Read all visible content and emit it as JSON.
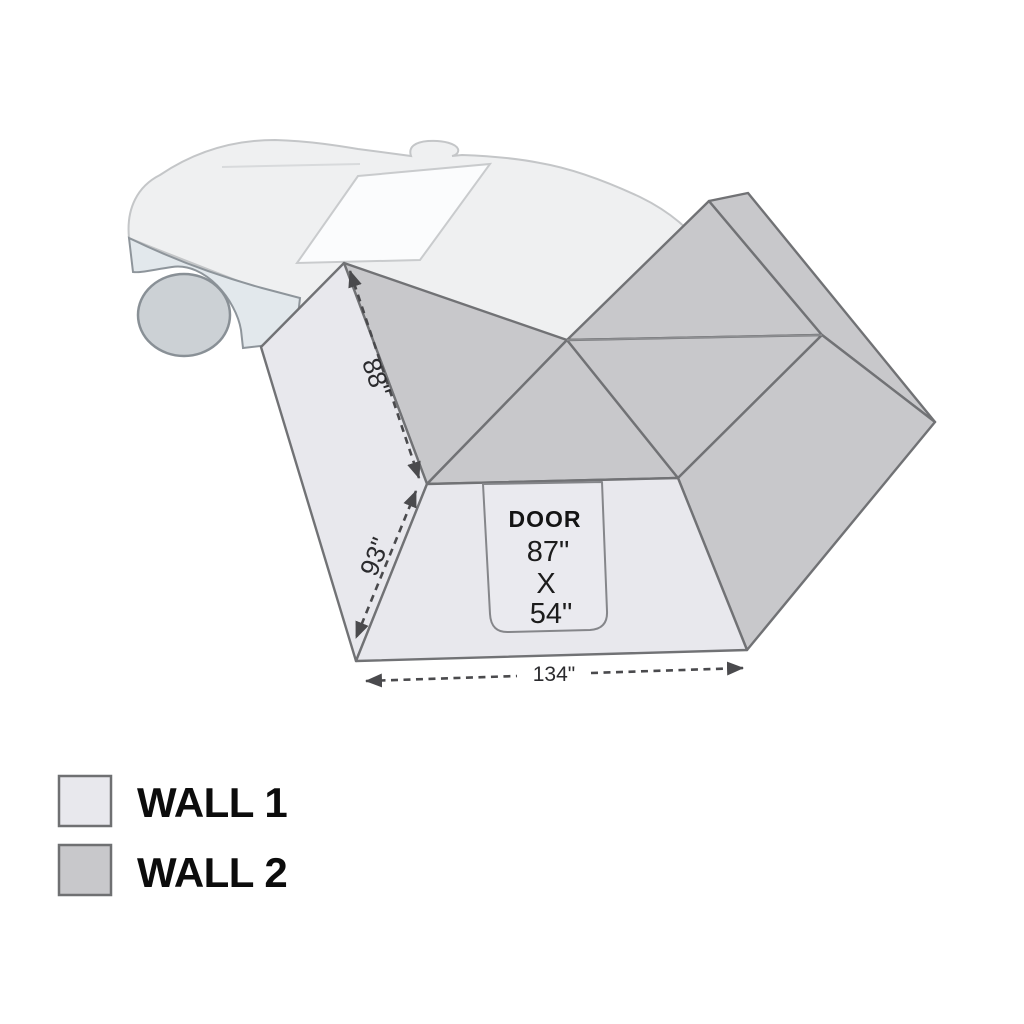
{
  "colors": {
    "wall1": "#e8e8ed",
    "wall2": "#c8c8cb",
    "door_fill": "#eaeaef",
    "structure_outline": "#717275",
    "thin_fold": "#8e8f92",
    "dimension": "#4a4a4d",
    "car_body": "#eff0f1",
    "car_body_outline": "#c4c6c8",
    "car_rear_panel": "#e2e8ec",
    "car_rear_panel_outline": "#8e959b",
    "car_wheel": "#ccd1d5",
    "car_wheel_outline": "#899096",
    "car_window": "#fbfcfd"
  },
  "dimensions": {
    "roof_edge": "88\"",
    "side_edge": "93\"",
    "base": "134\""
  },
  "door": {
    "label": "DOOR",
    "line1": "87\"",
    "line2": "X",
    "line3": "54\""
  },
  "legend": [
    {
      "label": "WALL 1",
      "color": "#e8e8ed"
    },
    {
      "label": "WALL 2",
      "color": "#c8c8cb"
    }
  ]
}
